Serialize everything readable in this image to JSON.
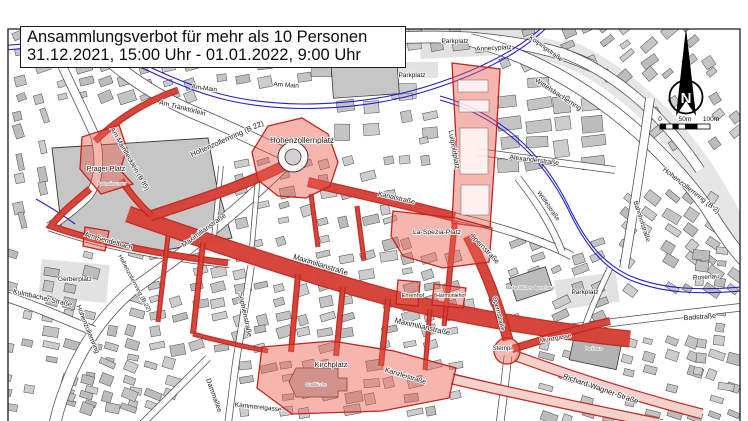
{
  "title": {
    "line1": "Ansammlungsverbot für mehr als 10 Personen",
    "line2": "31.12.2021, 15:00 Uhr - 01.01.2022, 9:00 Uhr"
  },
  "compass": {
    "north": "N"
  },
  "scale_bar": {
    "start": "0",
    "mid": "50m",
    "end": "100m"
  },
  "colors": {
    "zone_border": "#c3241c",
    "zone_fill": "#e85d50",
    "zone_fill_pale": "#f7e3df",
    "building_fill": "#c9c9c9",
    "road_casing": "#3c3c3c",
    "water": "#2222cc"
  },
  "labels": {
    "am_main_1": "Am Main",
    "am_main_2": "Am Main",
    "am_traenktoerlein": "Am Tränktörlein",
    "hohenzollernring_b22": "Hohenzollernring (B 22)",
    "am_mainflecklein": "Am Mainflecklein (B 85)",
    "hohenzollernplatz": "Hohenzollernplatz",
    "prager_platz": "Prager Platz",
    "am_sendelbach": "Am Sendelbach",
    "rotmaincenter": "Rotmaincenter",
    "gerberplatz": "Gerberplatz",
    "kulmbacher_strasse": "Kulmbacher Straße",
    "hohenzollernring_s": "Hohenzollernring",
    "hohenzollernring_b22s": "Hohenzollernring (B 22)",
    "dammallee": "Dammallee",
    "maximilianstrasse_w": "Maximilianstraße",
    "maximilianstrasse_m": "Maximilianstraße",
    "maximilianstrasse_e": "Maximilianstraße",
    "sophienstrasse": "Sophienstraße",
    "kaemmereigasse": "Kämmereigasse",
    "kirchplatz": "Kirchplatz",
    "stadtkirche": "Stadtkirche",
    "kanzleistrasse": "Kanzleistraße",
    "kanalstrasse": "Kanalstraße",
    "luitpoldplatz": "Luitpoldplatz",
    "parkplatz_1": "Parkplatz",
    "parkplatz_2": "Parkplatz",
    "parkplatz_3": "Parkplatz",
    "annecyplatz": "Annecyplatz",
    "kolpingstrasse": "Kolpingstraße",
    "wittelsbacherring": "Wittelsbacherring",
    "hohenzollernring_b2": "Hohenzollernring (B 2)",
    "bahnhofstrasse": "Bahnhofstraße",
    "alexanderstrasse": "Alexanderstraße",
    "woelfelstrasse": "Wölfelstraße",
    "la_spezia_platz": "La-Spezia-Platz",
    "opernstrasse_1": "Opernstraße",
    "opernstrasse_2": "Opernstraße",
    "opernhaus": "Markgräfliches Opernhaus",
    "ehrenhof": "Ehrenhof",
    "harmoniehof": "Harmoniehof",
    "sternplatz": "Sternpl.",
    "muenzgasse": "Münzgasse",
    "richard_wagner_strasse": "Richard-Wagner-Straße",
    "badstrasse": "Badstraße",
    "rosenau": "Rosenau",
    "parkhaus": "Parkhaus"
  }
}
